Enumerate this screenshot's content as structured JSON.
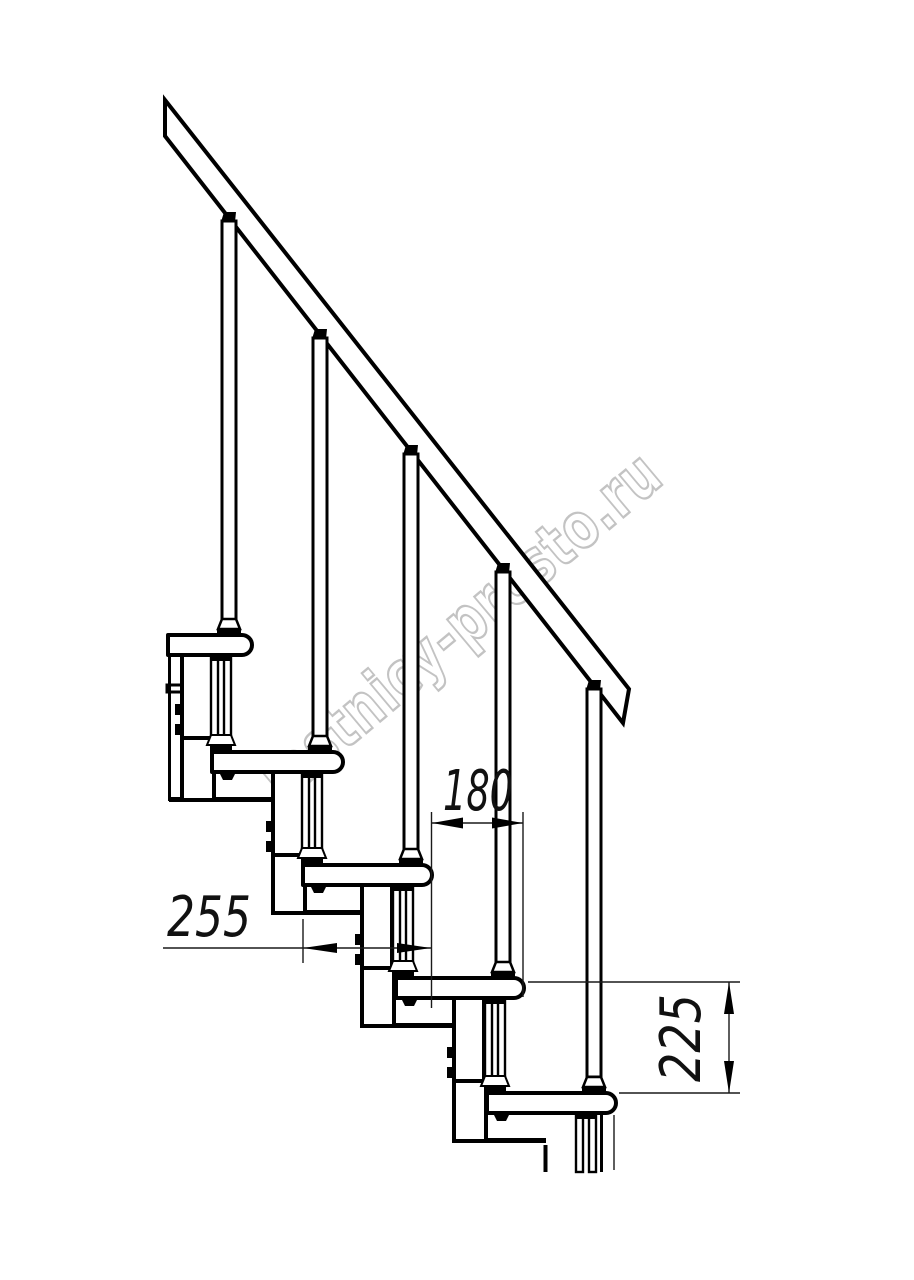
{
  "drawing": {
    "watermark": "lestnicy-prosto.ru",
    "dimensions": {
      "going": "180",
      "tread_depth": "255",
      "rise": "225"
    },
    "colors": {
      "line": "#000000",
      "dim_line": "#1a1a1a",
      "watermark": "#c3c3c3",
      "background": "#ffffff"
    }
  }
}
